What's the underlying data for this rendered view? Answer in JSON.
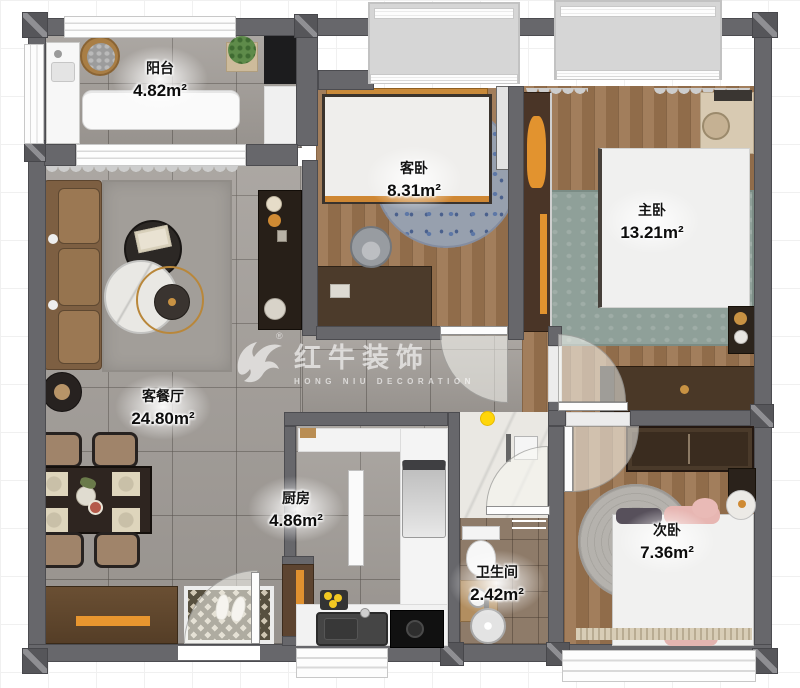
{
  "watermark": {
    "brand": "红牛装饰",
    "subtitle": "HONG NIU DECORATION",
    "registered": "®"
  },
  "rooms": {
    "balcony": {
      "name": "阳台",
      "area": "4.82m²"
    },
    "guest_bedroom": {
      "name": "客卧",
      "area": "8.31m²"
    },
    "master_bedroom": {
      "name": "主卧",
      "area": "13.21m²"
    },
    "living_dining": {
      "name": "客餐厅",
      "area": "24.80m²"
    },
    "kitchen": {
      "name": "厨房",
      "area": "4.86m²"
    },
    "bathroom": {
      "name": "卫生间",
      "area": "2.42m²"
    },
    "second_bedroom": {
      "name": "次卧",
      "area": "7.36m²"
    }
  },
  "colors": {
    "wall_gray": "#67676b",
    "tile_floor": "#a29d98",
    "wood_floor": "#9b7450",
    "bath_tile": "#8e7b69",
    "accent_orange": "#e2932f",
    "highlight_dot": "#ffd60a",
    "watermark_white": "#ffffff"
  }
}
